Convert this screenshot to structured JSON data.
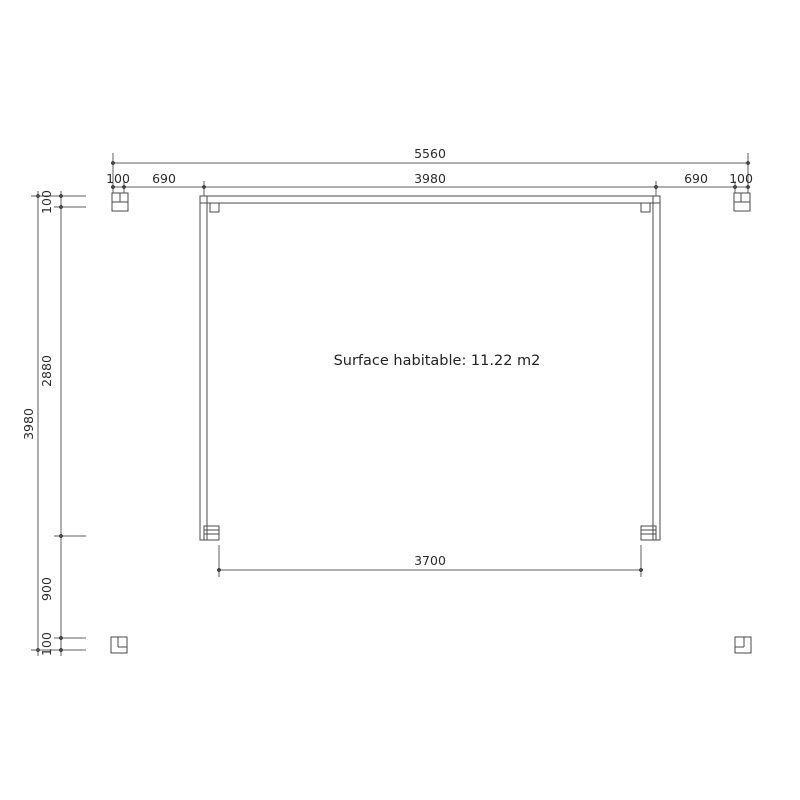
{
  "drawing": {
    "kind": "floor-plan",
    "area_note": "Surface habitable: 11.22 m2",
    "dimensions": {
      "top_total": "5560",
      "top_seg_100_left": "100",
      "top_seg_690_left": "690",
      "top_seg_3980": "3980",
      "top_seg_690_right": "690",
      "top_seg_100_right": "100",
      "left_total": "3980",
      "left_seg_100_top": "100",
      "left_seg_2880": "2880",
      "left_seg_900": "900",
      "left_seg_100_bottom": "100",
      "bottom_span": "3700"
    },
    "colors": {
      "background": "#ffffff",
      "dimension_line": "#5f5f5f",
      "structure_line": "#4a4a4a",
      "text": "#2b2b2b"
    }
  }
}
